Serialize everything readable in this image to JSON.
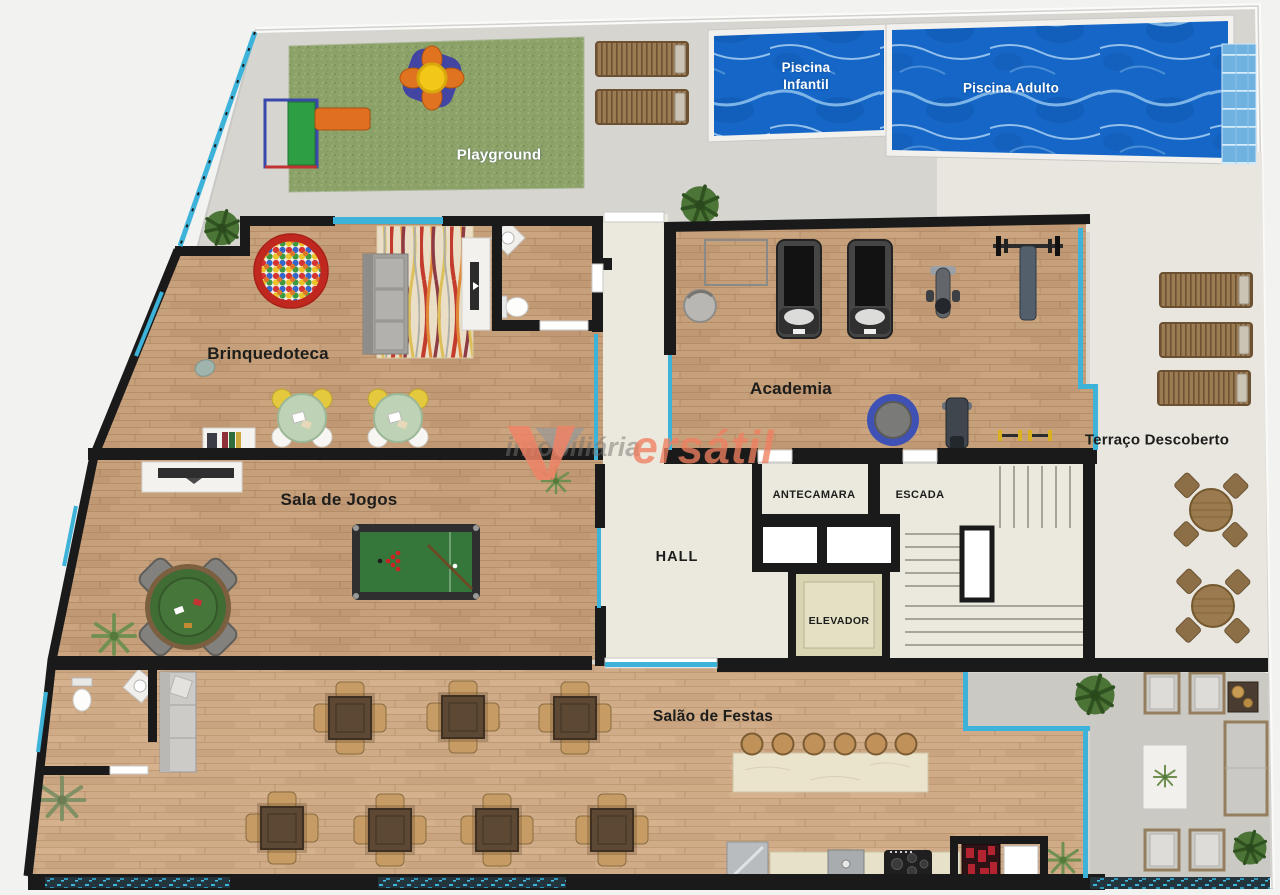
{
  "page": {
    "type": "architectural-floor-plan",
    "description": "Leisure-area floor plan of a residential building (imobiliária Versátil)"
  },
  "colors": {
    "wall": "#1a1a1a",
    "glass": "#3eb3da",
    "pool_water": "#1566c6",
    "grass": "#8da269",
    "wood_floor": "#c6a07b",
    "deck_gray": "#d7d5d0",
    "terrace_beige": "#e9e6df",
    "lounge_gray": "#cbc9c4",
    "circulation_cream": "#ebe8dd",
    "elevator_beige": "#d8d5b2",
    "watermark_orange": "#ee8366",
    "watermark_gray": "#979592",
    "label_dark": "#1d1d1b",
    "label_light": "#ffffff"
  },
  "areas": {
    "playground": {
      "label": "Playground"
    },
    "piscina_infantil": {
      "line1": "Piscina",
      "line2": "Infantil"
    },
    "piscina_adulto": {
      "label": "Piscina Adulto"
    },
    "brinquedoteca": {
      "label": "Brinquedoteca"
    },
    "academia": {
      "label": "Academia"
    },
    "terraco_descoberto": {
      "label": "Terraço Descoberto"
    },
    "sala_de_jogos": {
      "label": "Sala de Jogos"
    },
    "hall": {
      "label": "HALL"
    },
    "antecamara": {
      "label": "ANTECAMARA"
    },
    "escada": {
      "label": "ESCADA"
    },
    "elevador": {
      "label": "ELEVADOR"
    },
    "salao_de_festas": {
      "label": "Salão de Festas"
    }
  },
  "watermark": {
    "prefix": "imobiliária",
    "suffix": "ersátil",
    "brand": "Versátil"
  }
}
